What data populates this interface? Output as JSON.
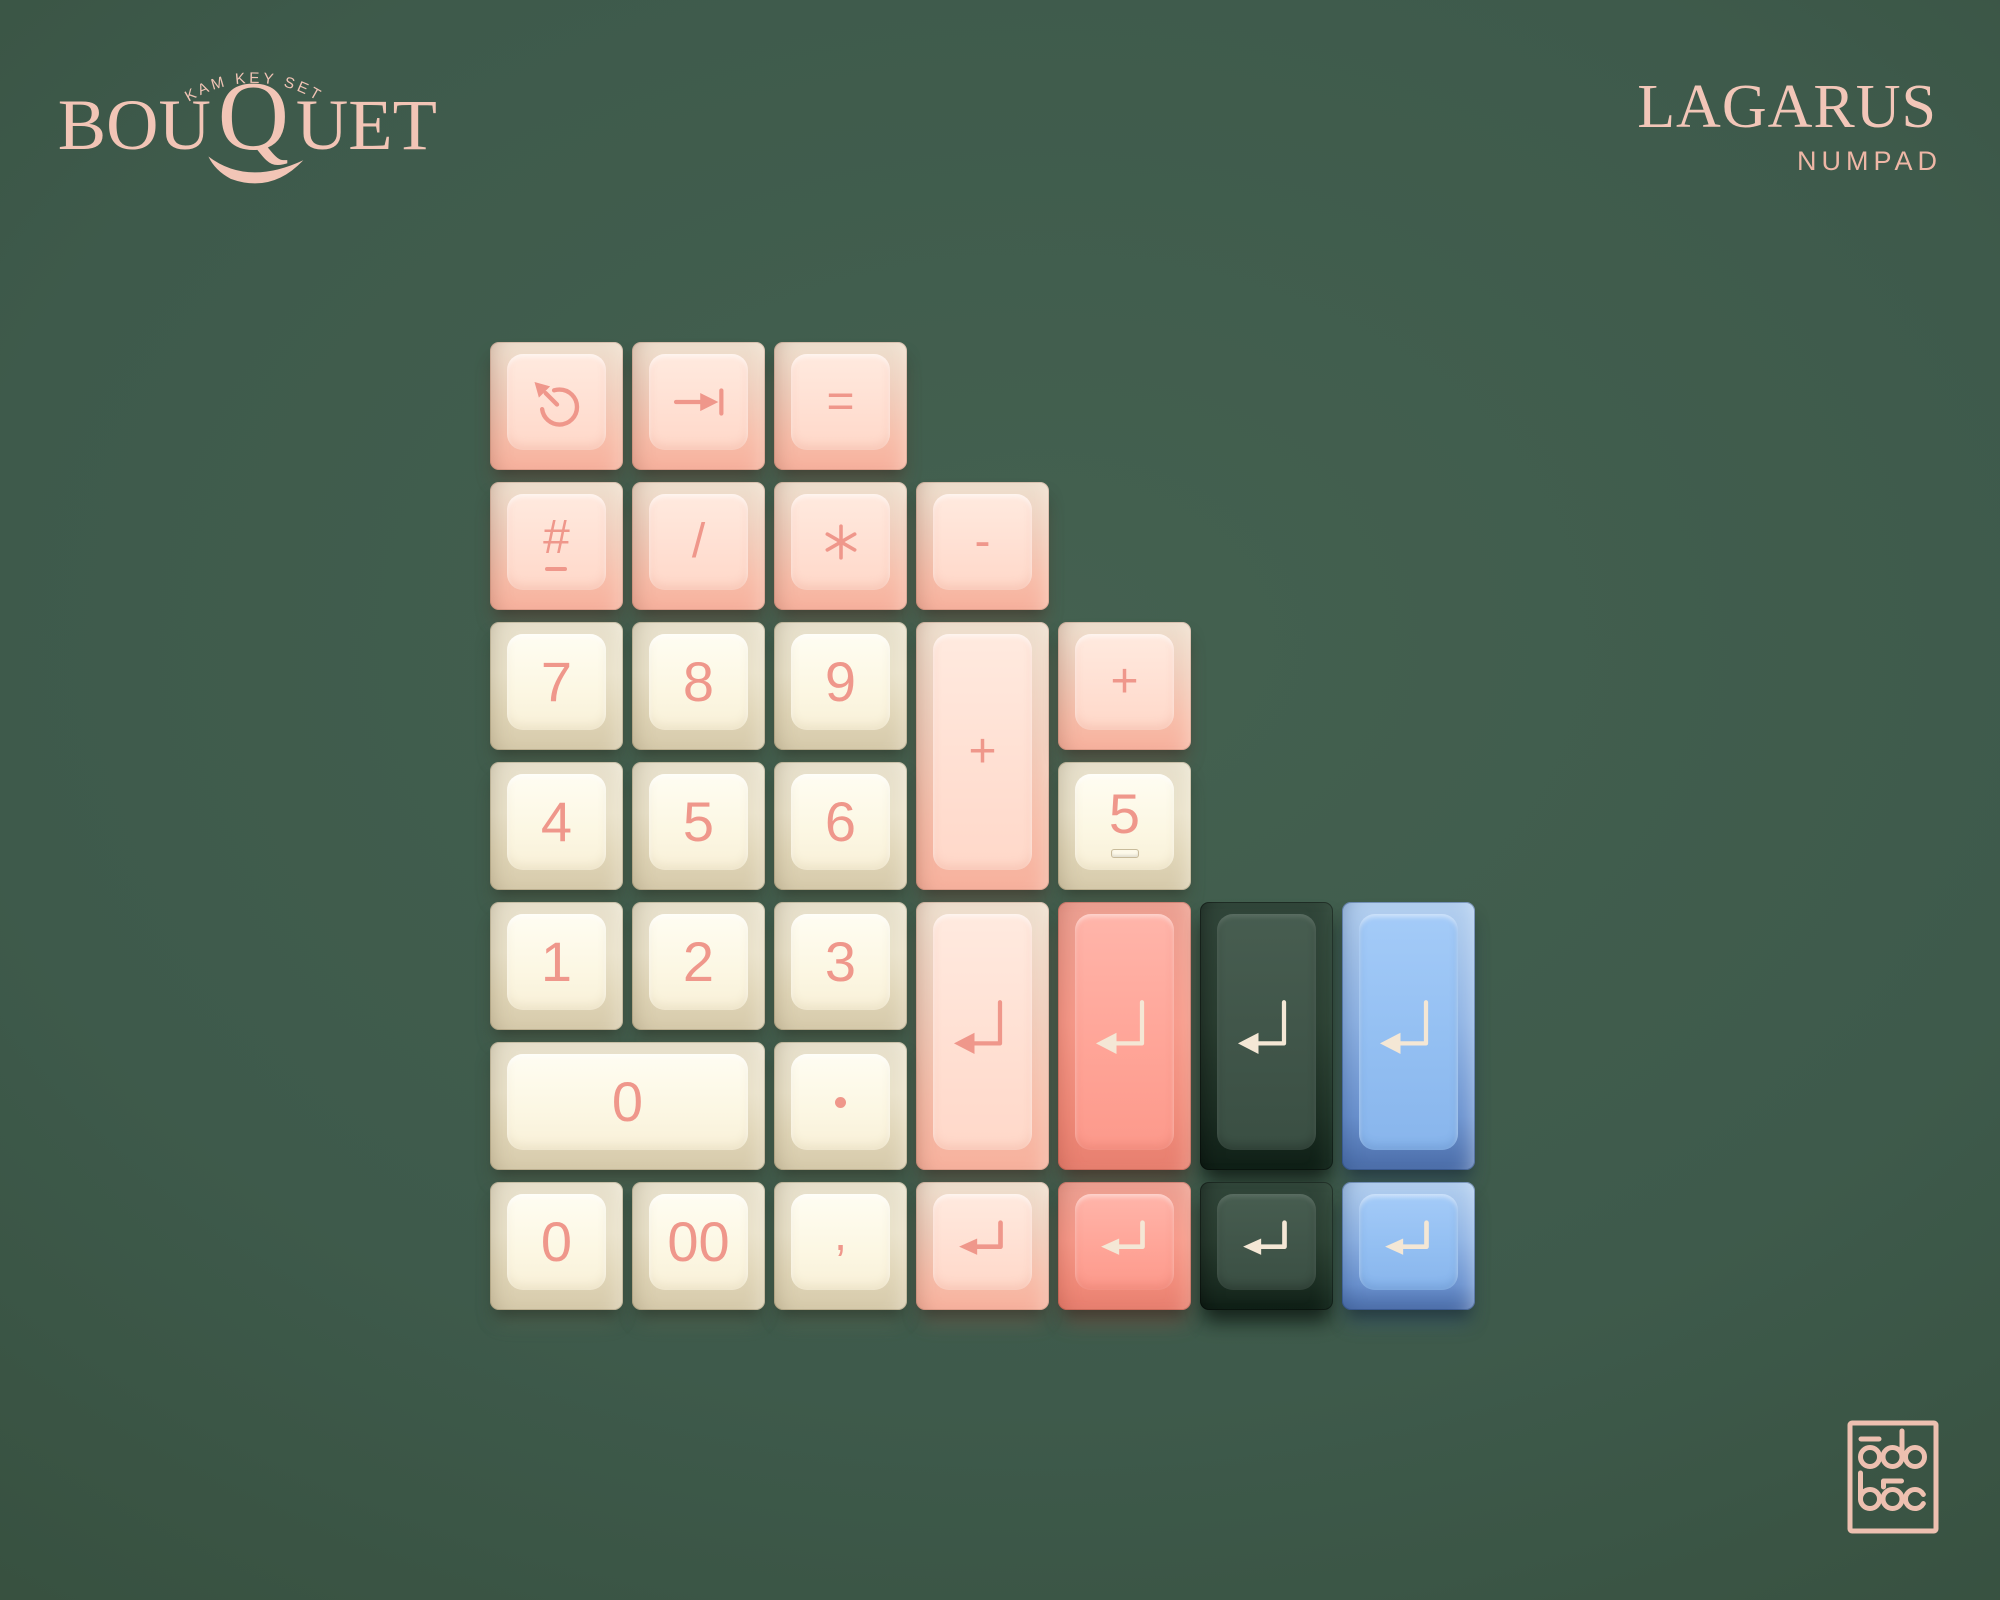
{
  "branding": {
    "kit_logo": {
      "arch_text": "KAM KEY SET",
      "title": "BOUQUET",
      "title_parts": [
        "BOU",
        "Q",
        "UET"
      ]
    },
    "set_name": "LAGARUS",
    "set_subtitle": "NUMPAD",
    "maker_logo": "odo-boc-monogram"
  },
  "palette": {
    "background": "#3a5547",
    "brand_pink": "#f2c5b6",
    "pink_key": "#f7b19d",
    "cream_key": "#faf3dd",
    "salmon_key": "#f89a8c",
    "green_key": "#3c5146",
    "blue_key": "#92bdf0",
    "warm_legend": "#ef978b",
    "cream_legend": "#f4e7d5"
  },
  "keys": [
    {
      "id": "cycle",
      "row": 1,
      "col": 1,
      "color": "pink",
      "icon": "cycle-arrow-icon"
    },
    {
      "id": "tab",
      "row": 1,
      "col": 2,
      "color": "pink",
      "icon": "tab-arrow-icon"
    },
    {
      "id": "equals",
      "row": 1,
      "col": 3,
      "color": "pink",
      "legend": "="
    },
    {
      "id": "hash",
      "row": 2,
      "col": 1,
      "color": "pink",
      "legend": "#",
      "underline": true
    },
    {
      "id": "slash",
      "row": 2,
      "col": 2,
      "color": "pink",
      "legend": "/"
    },
    {
      "id": "asterisk",
      "row": 2,
      "col": 3,
      "color": "pink",
      "legend": "*",
      "icon": "asterisk-icon"
    },
    {
      "id": "minus",
      "row": 2,
      "col": 4,
      "color": "pink",
      "legend": "-"
    },
    {
      "id": "seven",
      "row": 3,
      "col": 1,
      "color": "cream",
      "legend": "7"
    },
    {
      "id": "eight",
      "row": 3,
      "col": 2,
      "color": "cream",
      "legend": "8"
    },
    {
      "id": "nine",
      "row": 3,
      "col": 3,
      "color": "cream",
      "legend": "9"
    },
    {
      "id": "plus-tall",
      "row": 3,
      "col": 4,
      "h": 2,
      "color": "pink",
      "legend": "+"
    },
    {
      "id": "plus",
      "row": 3,
      "col": 5,
      "color": "pink",
      "legend": "+"
    },
    {
      "id": "four",
      "row": 4,
      "col": 1,
      "color": "cream",
      "legend": "4"
    },
    {
      "id": "five",
      "row": 4,
      "col": 2,
      "color": "cream",
      "legend": "5"
    },
    {
      "id": "six",
      "row": 4,
      "col": 3,
      "color": "cream",
      "legend": "6"
    },
    {
      "id": "five-homing",
      "row": 4,
      "col": 5,
      "color": "cream",
      "legend": "5",
      "homing": true
    },
    {
      "id": "one",
      "row": 5,
      "col": 1,
      "color": "cream",
      "legend": "1"
    },
    {
      "id": "two",
      "row": 5,
      "col": 2,
      "color": "cream",
      "legend": "2"
    },
    {
      "id": "three",
      "row": 5,
      "col": 3,
      "color": "cream",
      "legend": "3"
    },
    {
      "id": "enter-pink-tall",
      "row": 5,
      "col": 4,
      "h": 2,
      "color": "pink",
      "icon": "enter-arrow-icon"
    },
    {
      "id": "enter-salmon-tall",
      "row": 5,
      "col": 5,
      "h": 2,
      "color": "salmon",
      "icon": "enter-arrow-icon"
    },
    {
      "id": "enter-green-tall",
      "row": 5,
      "col": 6,
      "h": 2,
      "color": "green",
      "icon": "enter-arrow-icon"
    },
    {
      "id": "enter-blue-tall",
      "row": 5,
      "col": 7,
      "h": 2,
      "color": "blue",
      "icon": "enter-arrow-icon"
    },
    {
      "id": "zero-wide",
      "row": 6,
      "col": 1,
      "w": 2,
      "color": "cream",
      "legend": "0"
    },
    {
      "id": "decimal",
      "row": 6,
      "col": 3,
      "color": "cream",
      "legend": "."
    },
    {
      "id": "zero",
      "row": 7,
      "col": 1,
      "color": "cream",
      "legend": "0"
    },
    {
      "id": "double-zero",
      "row": 7,
      "col": 2,
      "color": "cream",
      "legend": "00"
    },
    {
      "id": "comma",
      "row": 7,
      "col": 3,
      "color": "cream",
      "legend": ","
    },
    {
      "id": "enter-pink",
      "row": 7,
      "col": 4,
      "color": "pink",
      "icon": "enter-arrow-icon"
    },
    {
      "id": "enter-salmon",
      "row": 7,
      "col": 5,
      "color": "salmon",
      "icon": "enter-arrow-icon"
    },
    {
      "id": "enter-green",
      "row": 7,
      "col": 6,
      "color": "green",
      "icon": "enter-arrow-icon"
    },
    {
      "id": "enter-blue",
      "row": 7,
      "col": 7,
      "color": "blue",
      "icon": "enter-arrow-icon"
    }
  ]
}
